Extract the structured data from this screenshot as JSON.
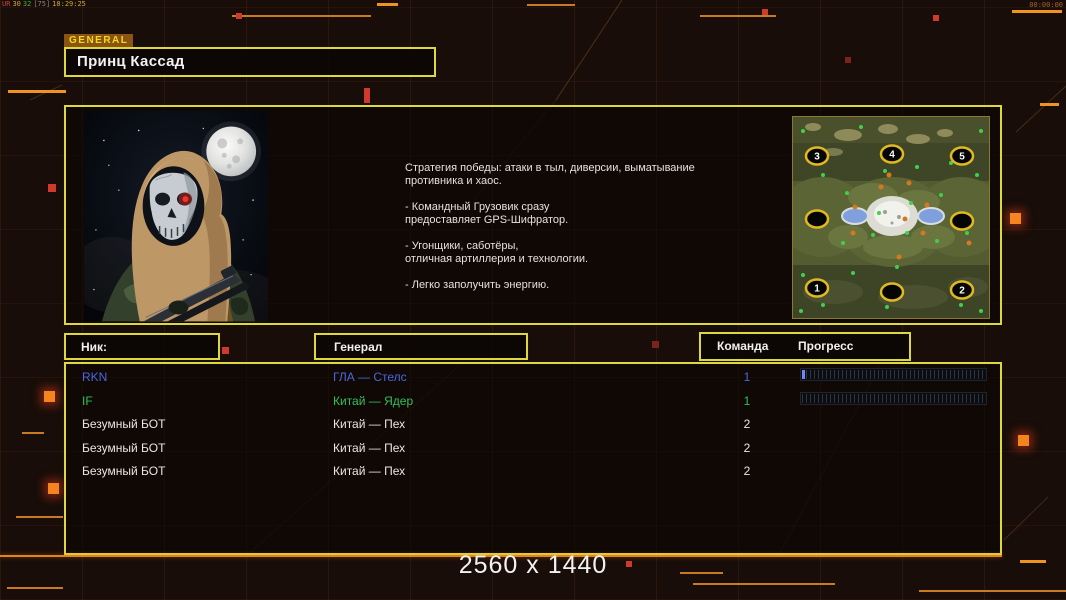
{
  "hud": {
    "debug_segments": [
      {
        "text": "UR",
        "color": "#c8443a"
      },
      {
        "text": "30",
        "color": "#c8a832"
      },
      {
        "text": "32",
        "color": "#3fae3f"
      },
      {
        "text": "[75]",
        "color": "#8a8078"
      },
      {
        "text": "18:29:25",
        "color": "#c8a832"
      }
    ],
    "clock": "00:00:00"
  },
  "header": {
    "tab_label": "GENERAL",
    "general_name": "Принц Кассад"
  },
  "briefing": {
    "text": "Стратегия победы: атаки в тыл, диверсии, выматывание\n противника и хаос.\n\n- Командный Грузовик сразу\nпредоставляет GPS-Шифратор.\n\n- Угонщики, саботёры,\nотличная артиллерия и технологии.\n\n- Легко заполучить энергию."
  },
  "minimap": {
    "spawns": [
      {
        "label": "3"
      },
      {
        "label": "4"
      },
      {
        "label": "5"
      },
      {
        "label": ""
      },
      {
        "label": ""
      },
      {
        "label": "1"
      },
      {
        "label": ""
      },
      {
        "label": "2"
      }
    ]
  },
  "table": {
    "headers": {
      "nick": "Ник:",
      "general": "Генерал",
      "team": "Команда",
      "progress": "Прогресс"
    },
    "rows": [
      {
        "nick": "RKN",
        "general": "ГЛА — Стелс",
        "team": "1",
        "color": "#4a66e0",
        "bar_fill_color": "#6f86ff"
      },
      {
        "nick": "IF",
        "general": "Китай — Ядер",
        "team": "1",
        "color": "#2fc25a"
      },
      {
        "nick": "Безумный БОТ",
        "general": "Китай — Пех",
        "team": "2",
        "color": "#e8e6e2"
      },
      {
        "nick": "Безумный БОТ",
        "general": "Китай — Пех",
        "team": "2",
        "color": "#e8e6e2"
      },
      {
        "nick": "Безумный БОТ",
        "general": "Китай — Пех",
        "team": "2",
        "color": "#e8e6e2"
      }
    ]
  },
  "footer": {
    "resolution": "2560 x 1440"
  },
  "colors": {
    "panel_border": "#ddd83e",
    "accent_orange": "#e8821c",
    "tab_bg": "#8a5513",
    "tab_text": "#f7d71f"
  }
}
